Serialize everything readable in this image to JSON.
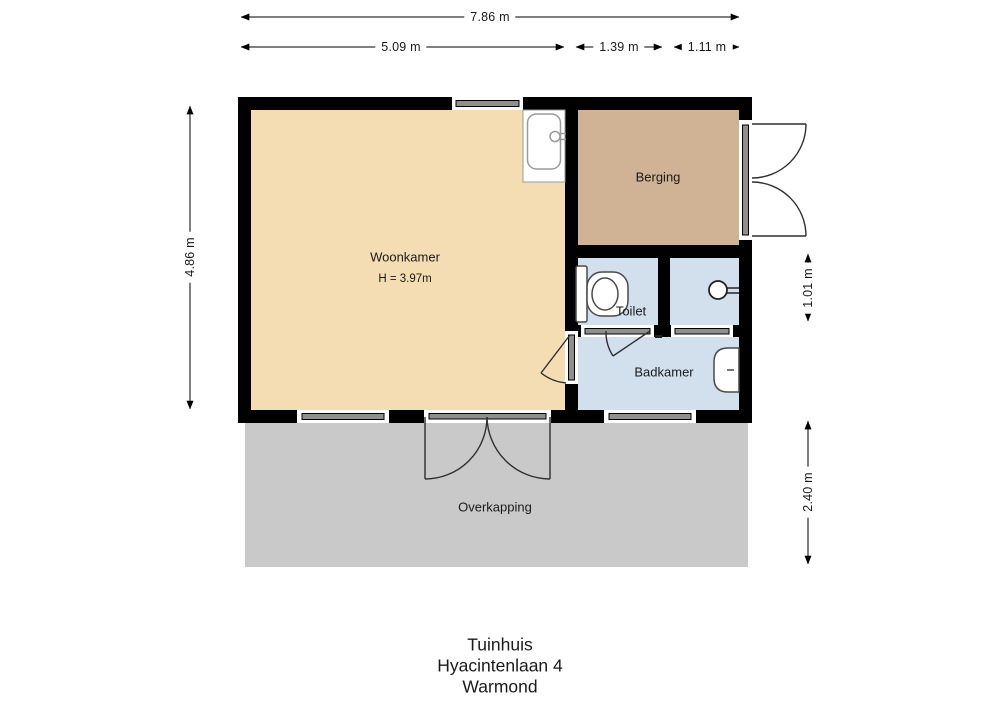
{
  "plan": {
    "rooms": {
      "woonkamer": {
        "label": "Woonkamer",
        "height_note": "H = 3.97m"
      },
      "berging": {
        "label": "Berging"
      },
      "toilet": {
        "label": "Toilet"
      },
      "badkamer": {
        "label": "Badkamer"
      },
      "overkapping": {
        "label": "Overkapping"
      }
    },
    "dimensions": {
      "total_width": "7.86 m",
      "segment_left": "5.09 m",
      "segment_mid": "1.39 m",
      "segment_right": "1.11 m",
      "left_height": "4.86 m",
      "right_upper": "1.01 m",
      "right_lower": "2.40 m"
    },
    "fixtures": {
      "kitchen_sink": "kitchen-sink",
      "toilet_wc": "toilet",
      "shower": "shower-head",
      "washbasin": "washbasin"
    }
  },
  "title_block": {
    "building": "Tuinhuis",
    "street": "Hyacintenlaan 4",
    "city": "Warmond"
  },
  "colors": {
    "wall": "#000000",
    "woonkamer": "#f4ddb2",
    "berging": "#d0b294",
    "wetroom": "#d2e0ee",
    "overkapping": "#c9c9c9",
    "window": "#8f8f8f",
    "line": "#2f2f2f"
  }
}
